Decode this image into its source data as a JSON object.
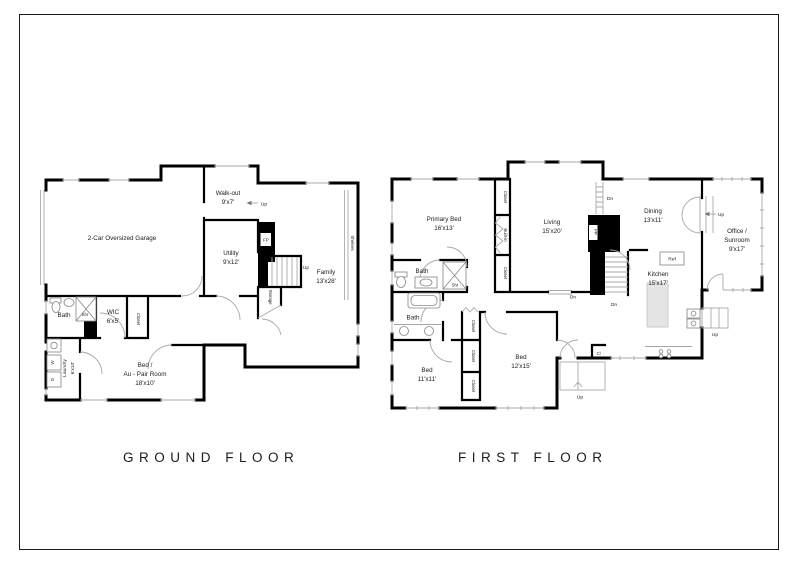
{
  "ground": {
    "title": "GROUND FLOOR",
    "garage": "2-Car Oversized Garage",
    "walkout_name": "Walk-out",
    "walkout_dims": "9'x7'",
    "utility_name": "Utility",
    "utility_dims": "9'x12'",
    "family_name": "Family",
    "family_dims": "13'x28'",
    "fp": "FP",
    "shelves": "Shelves",
    "storage": "Storage",
    "bath": "Bath",
    "shr": "Shr",
    "wic_name": "WIC",
    "wic_dims": "6'x5'",
    "closet": "Closet",
    "laundry_name": "Laundry",
    "laundry_dims": "6'x10'",
    "washer": "W",
    "dryer": "D",
    "bed_line1": "Bed /",
    "bed_line2": "Au - Pair Room",
    "bed_dims": "18'x10'",
    "up": "Up"
  },
  "first": {
    "title": "FIRST FLOOR",
    "primary_name": "Primary Bed",
    "primary_dims": "16'x13'",
    "living_name": "Living",
    "living_dims": "15'x20'",
    "dining_name": "Dining",
    "dining_dims": "13'x11'",
    "office_line1": "Office /",
    "office_line2": "Sunroom",
    "office_dims": "9'x17'",
    "kitchen_name": "Kitchen",
    "kitchen_dims": "15'x17'",
    "bed11_name": "Bed",
    "bed11_dims": "11'x11'",
    "bed12_name": "Bed",
    "bed12_dims": "12'x15'",
    "bath": "Bath",
    "shr": "Shr",
    "closet": "Closet",
    "built_in": "Built-in",
    "fp": "FP",
    "ref": "Ref",
    "cl": "Cl",
    "up": "Up",
    "dn": "Dn"
  }
}
